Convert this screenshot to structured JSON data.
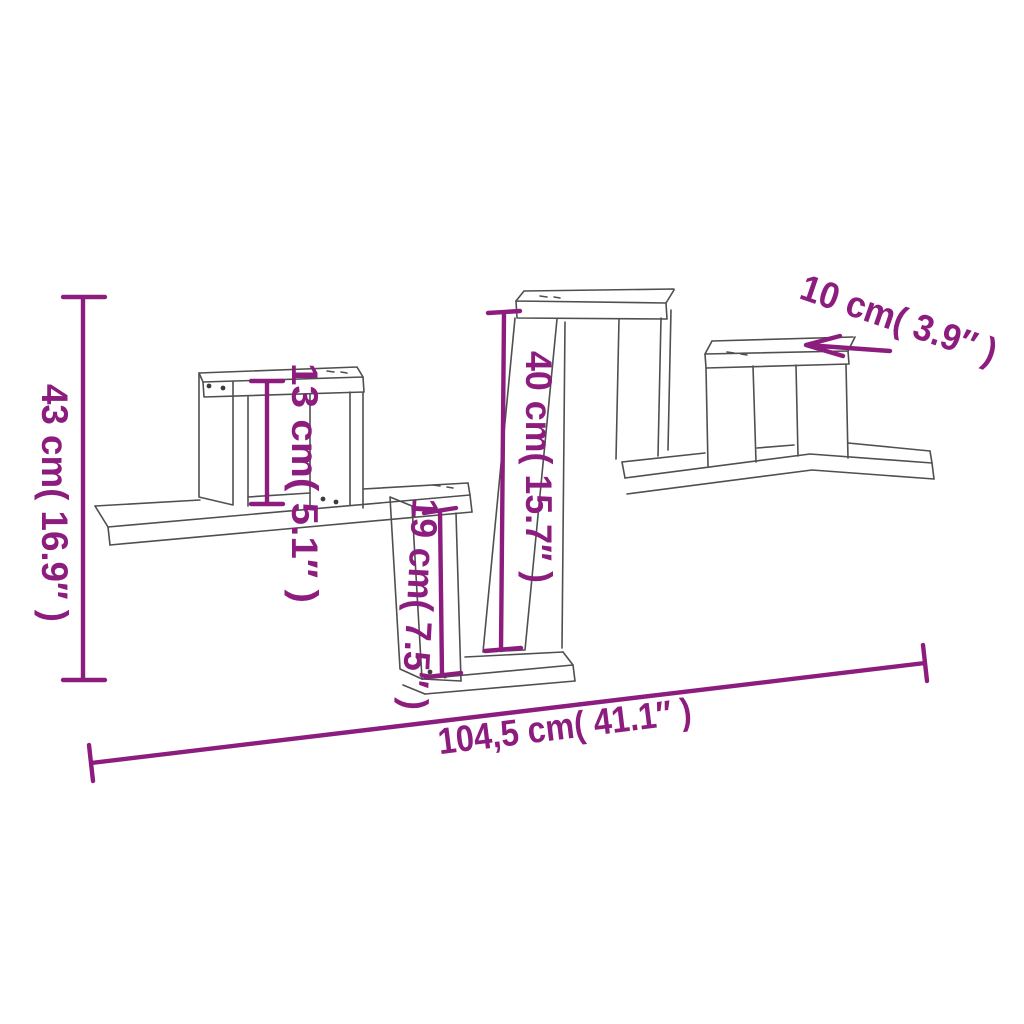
{
  "figure": {
    "type": "product-dimension-diagram",
    "subject": "zigzag wall cube shelf line drawing",
    "background_color": "#ffffff",
    "line_color": "#4f4f4f",
    "dimension_color": "#8c1d7e",
    "dimensions": {
      "total_height": "43 cm( 16.9″ )",
      "small_cube_height": "13 cm( 5.1″ )",
      "tall_section_height": "40 cm( 15.7″ )",
      "drop_section_height": "19 cm( 7.5″ )",
      "shelf_depth": "10 cm( 3.9″ )",
      "total_width": "104,5 cm( 41.1″ )"
    }
  }
}
